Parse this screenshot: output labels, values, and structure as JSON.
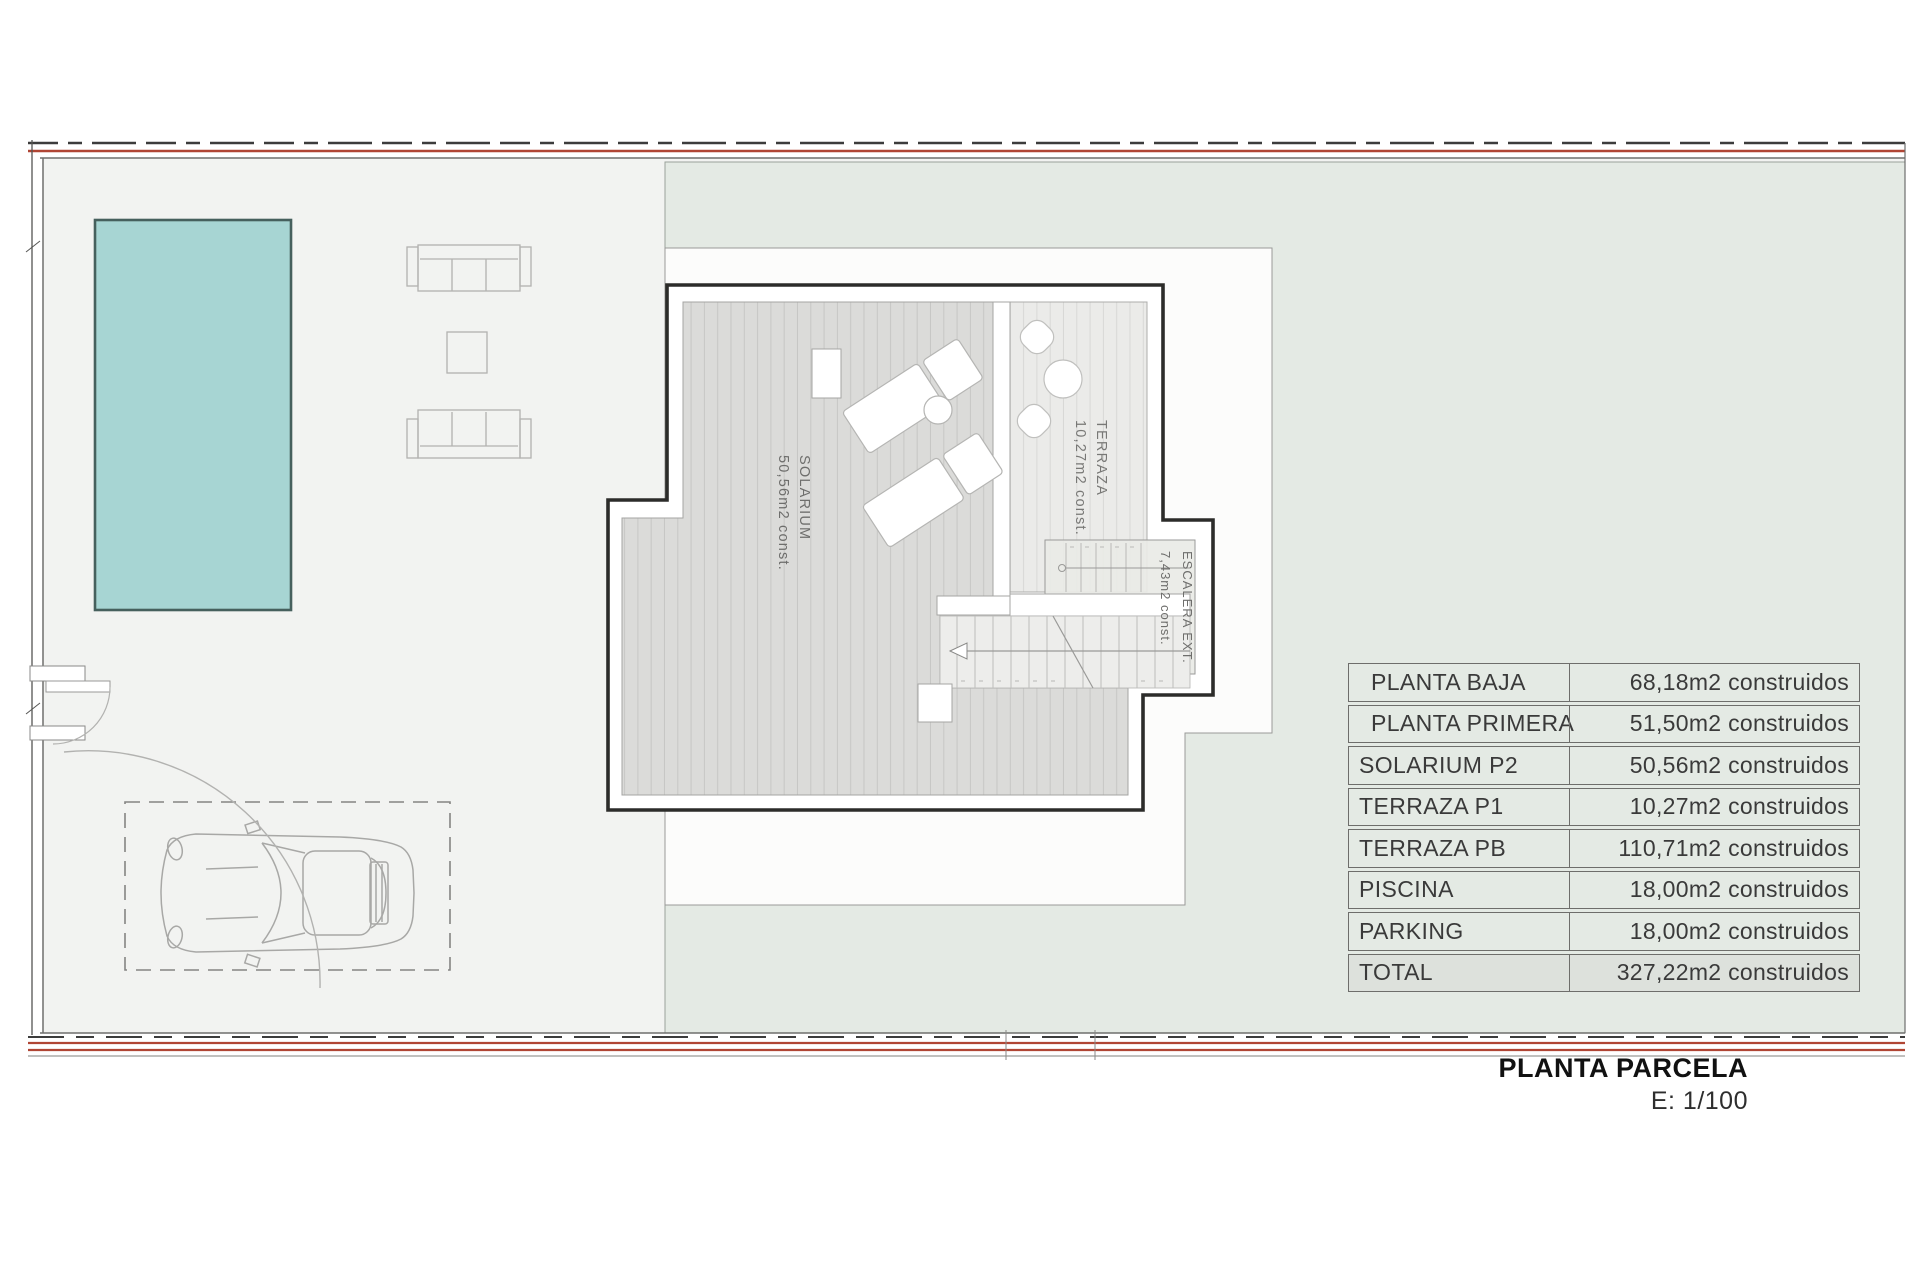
{
  "title_block": {
    "title": "PLANTA PARCELA",
    "scale": "E: 1/100"
  },
  "plan_labels": {
    "solarium": {
      "name": "SOLARIUM",
      "area": "50,56m2 const."
    },
    "terraza": {
      "name": "TERRAZA",
      "area": "10,27m2 const."
    },
    "escalera": {
      "name": "ESCALERA EXT.",
      "area": "7,43m2 const."
    }
  },
  "areas_table": {
    "rows": [
      {
        "label": "PLANTA BAJA",
        "value": "68,18m2 construidos"
      },
      {
        "label": "PLANTA PRIMERA",
        "value": "51,50m2 construidos"
      },
      {
        "label": "SOLARIUM P2",
        "value": "50,56m2 construidos"
      },
      {
        "label": "TERRAZA P1",
        "value": "10,27m2 construidos"
      },
      {
        "label": "TERRAZA PB",
        "value": "110,71m2 construidos"
      },
      {
        "label": "PISCINA",
        "value": "18,00m2 construidos"
      },
      {
        "label": "PARKING",
        "value": "18,00m2 construidos"
      },
      {
        "label": "TOTAL",
        "value": "327,22m2 construidos"
      }
    ]
  },
  "colors": {
    "pool": "#a7d5d3",
    "garden": "#e4eae4",
    "paving": "#f2f3f1",
    "deck": "#dbdbd9",
    "boundary_red": "#b04534",
    "wall": "#2c2c2a"
  }
}
